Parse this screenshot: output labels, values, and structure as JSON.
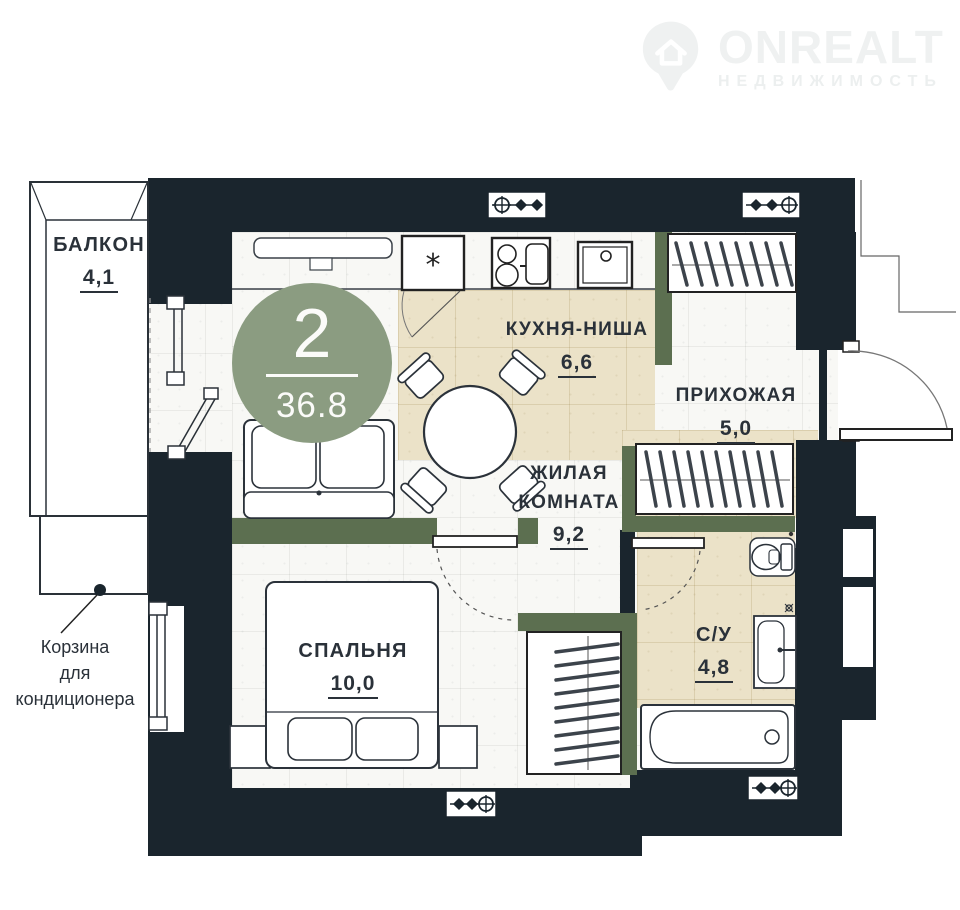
{
  "watermark": {
    "brand": "ONREALT",
    "subtitle": "НЕДВИЖИМОСТЬ",
    "icon": "house-pin-icon"
  },
  "badge": {
    "rooms_count": "2",
    "total_area": "36.8"
  },
  "rooms": [
    {
      "name": "БАЛКОН",
      "area": "4,1"
    },
    {
      "name": "КУХНЯ-НИША",
      "area": "6,6"
    },
    {
      "name": "ПРИХОЖАЯ",
      "area": "5,0"
    },
    {
      "name": "ЖИЛАЯ\nКОМНАТА",
      "area": "9,2"
    },
    {
      "name": "СПАЛЬНЯ",
      "area": "10,0"
    },
    {
      "name": "С/У",
      "area": "4,8"
    }
  ],
  "callout": {
    "text": "Корзина\nдля\nкондиционера"
  },
  "kitchen": {
    "fridge_mark": "*"
  },
  "fixtures": [
    "fridge",
    "stove",
    "kitchen-sink",
    "dining-table",
    "chairs",
    "sofa",
    "double-bed",
    "nightstands",
    "wardrobe-hallway",
    "wardrobe-closet",
    "wardrobe-corridor",
    "toilet",
    "washbasin",
    "bathtub",
    "entrance-door",
    "bedroom-door",
    "bathroom-door",
    "balcony-window",
    "balcony-door",
    "ventilation-marks",
    "ac-basket"
  ],
  "colors": {
    "wall": "#1a252d",
    "partition_green": "#5c6f50",
    "floor_beige": "#ebe2c8",
    "badge_green": "#8b9c81",
    "text": "#2a3139"
  }
}
